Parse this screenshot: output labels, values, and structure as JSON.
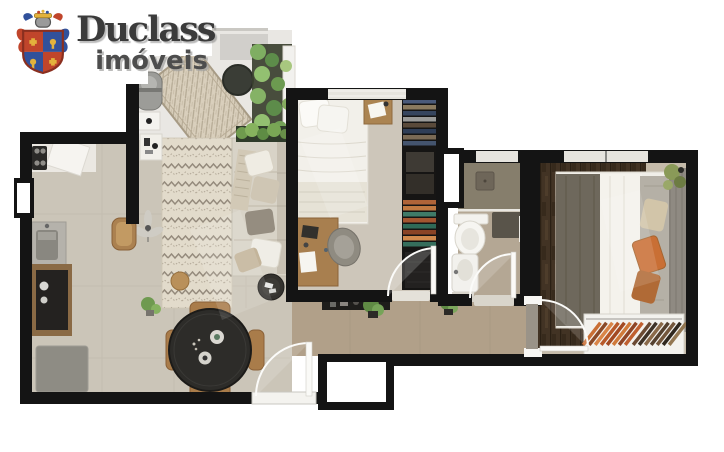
{
  "logo": {
    "title": "Duclass",
    "subtitle": "imóveis"
  },
  "palette": {
    "wall": "#141414",
    "floor_living": "#cbc5b8",
    "floor_balcony": "#e9e7e3",
    "floor_hall": "#b1a089",
    "floor_bed1": "#cdc6ba",
    "floor_bed2": "#c5bbaa",
    "floor_bath": "#b4a794",
    "shower": "#867e6c",
    "wood_rug": "#423324",
    "sofa": "#d8d3c7",
    "bed_white": "#f2f0ea",
    "dining_table": "#2d2c29",
    "wood_furniture": "#a87f4f",
    "plant_green": "#6f9a4e",
    "clothes_orange": "#c96f35",
    "clothes_brown": "#6b4a33",
    "crest_red": "#c0452b",
    "crest_blue": "#31519b",
    "crest_gold": "#e3b23c",
    "window_glass": "#e6e4de"
  }
}
